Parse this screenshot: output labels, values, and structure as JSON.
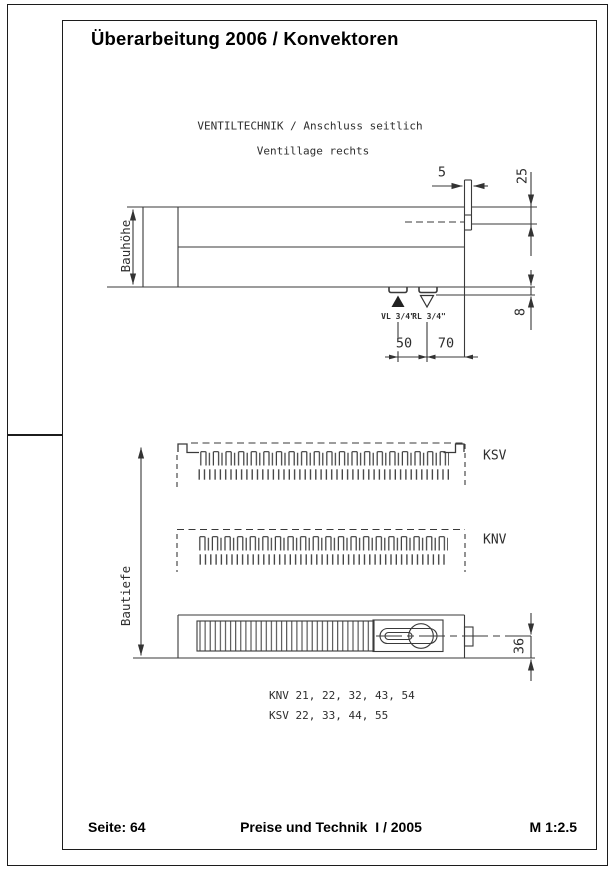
{
  "page": {
    "title": "Überarbeitung 2006 / Konvektoren",
    "footer": {
      "page_label": "Seite: 64",
      "publication": "Preise und Technik  I / 2005",
      "scale": "M 1:2.5"
    }
  },
  "drawing": {
    "heading": "VENTILTECHNIK / Anschluss seitlich",
    "subheading": "Ventillage rechts",
    "side_view": {
      "dim_tab_width": "5",
      "dim_tab_height": "25",
      "height_label": "Bauhöhe",
      "dim_stub_height": "8",
      "vl_label": "VL 3/4\"",
      "rl_label": "RL 3/4\"",
      "dim_vl_rl_spacing": "50",
      "dim_rl_edge_spacing": "70"
    },
    "top_views": {
      "ksv_label": "KSV",
      "knv_label": "KNV"
    },
    "front_view": {
      "depth_label": "Bautiefe",
      "dim_valve_height": "36"
    },
    "model_lines": {
      "knv": "KNV 21, 22, 32, 43, 54",
      "ksv": "KSV 22, 33, 44, 55"
    }
  }
}
